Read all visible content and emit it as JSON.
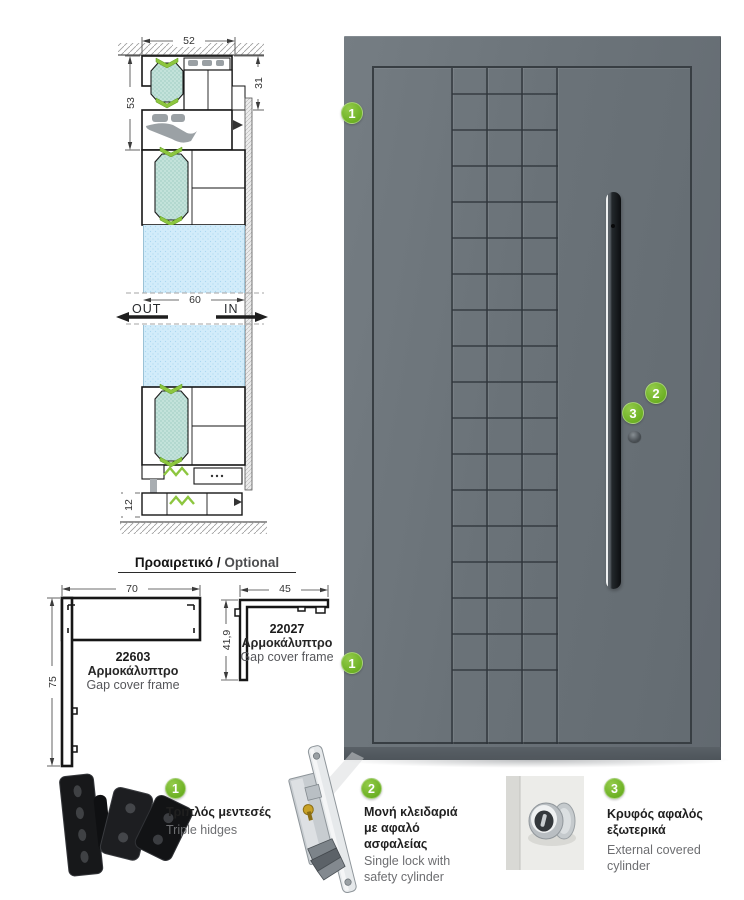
{
  "cross_section": {
    "dim_frame_width": "52",
    "dim_frame_height": "53",
    "dim_sash_height": "31",
    "dim_glass_width": "60",
    "dim_threshold_height": "12",
    "label_out": "OUT",
    "label_in": "IN"
  },
  "optional_section": {
    "title_greek": "Προαιρετικό /",
    "title_english": "Optional",
    "profiles": [
      {
        "code": "22603",
        "name_greek": "Αρμοκάλυπτρο",
        "name_english": "Gap cover frame",
        "dim_width": "70",
        "dim_height": "75"
      },
      {
        "code": "22027",
        "name_greek": "Αρμοκάλυπτρο",
        "name_english": "Gap cover frame",
        "dim_width": "45",
        "dim_height": "41,9"
      }
    ]
  },
  "door": {
    "markers": [
      {
        "label": "1"
      },
      {
        "label": "1"
      },
      {
        "label": "2"
      },
      {
        "label": "3"
      }
    ]
  },
  "features": [
    {
      "number": "1",
      "name_greek": "Τριπλός μεντεσές",
      "name_english": "Triple hidges"
    },
    {
      "number": "2",
      "name_greek": "Μονή κλειδαριά με αφαλό ασφαλείας",
      "name_english": "Single lock with safety cylinder"
    },
    {
      "number": "3",
      "name_greek": "Κρυφός αφαλός εξωτερικά",
      "name_english": "External covered cylinder"
    }
  ],
  "colors": {
    "accent_green": "#76b82a",
    "gasket_green": "#8dc63f",
    "thermal_break_teal": "#a7d3c9",
    "glass_blue": "#cdeaf9",
    "door_gray": "#6b737a",
    "handle_dark": "#1b1f23",
    "text_dark": "#231f20",
    "text_gray": "#6d6e71"
  }
}
